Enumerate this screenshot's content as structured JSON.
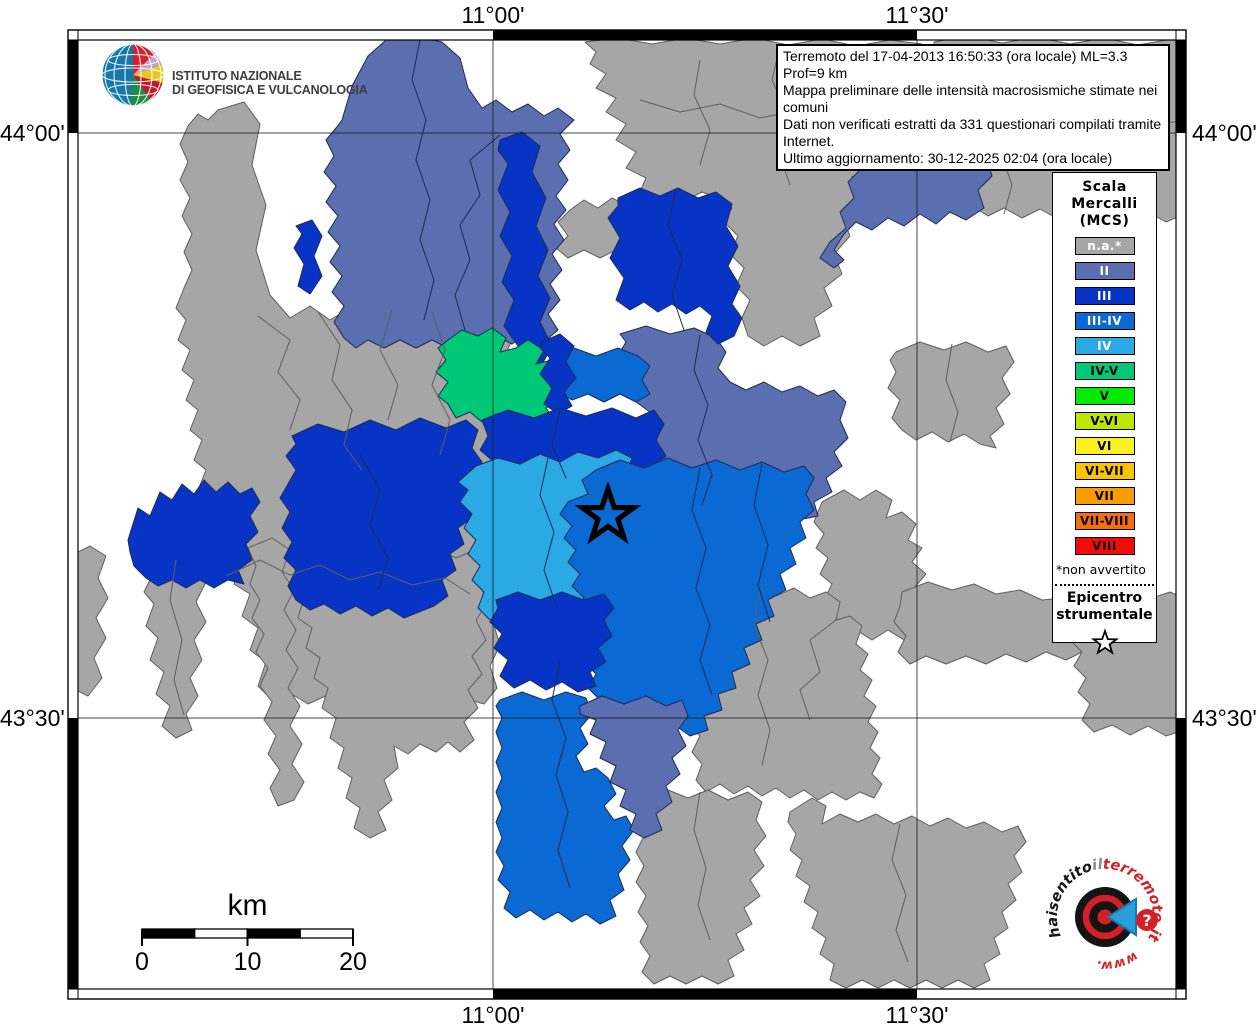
{
  "axes": {
    "meridians": [
      {
        "x": 493,
        "label": "11°00'"
      },
      {
        "x": 917,
        "label": "11°30'"
      }
    ],
    "parallels": [
      {
        "y": 133,
        "label": "44°00'"
      },
      {
        "y": 718,
        "label": "43°30'"
      }
    ]
  },
  "frame": {
    "x": 68,
    "y": 30,
    "w": 1118,
    "h": 969,
    "band": 10
  },
  "infobox": {
    "lines": [
      "Terremoto del 17-04-2013 16:50:33 (ora locale) ML=3.3 Prof=9 km",
      "Mappa preliminare delle intensità macrosismiche stimate nei comuni",
      "Dati non verificati estratti da 331 questionari compilati tramite Internet.",
      "Ultimo aggiornamento: 30-12-2025 02:04 (ora locale)"
    ]
  },
  "legend": {
    "title": "Scala\nMercalli\n(MCS)",
    "items": [
      {
        "key": "na",
        "label": "n.a.*",
        "color": "#A6A6A6",
        "text": "#ffffff"
      },
      {
        "key": "II",
        "label": "II",
        "color": "#5A6EB0",
        "text": "#ffffff"
      },
      {
        "key": "III",
        "label": "III",
        "color": "#0834C6",
        "text": "#ffffff"
      },
      {
        "key": "III-IV",
        "label": "III-IV",
        "color": "#0B69D4",
        "text": "#ffffff"
      },
      {
        "key": "IV",
        "label": "IV",
        "color": "#2BA9E4",
        "text": "#ffffff"
      },
      {
        "key": "IV-V",
        "label": "IV-V",
        "color": "#00C877",
        "text": "#000000"
      },
      {
        "key": "V",
        "label": "V",
        "color": "#00EB00",
        "text": "#000000"
      },
      {
        "key": "V-VI",
        "label": "V-VI",
        "color": "#BEE600",
        "text": "#000000"
      },
      {
        "key": "VI",
        "label": "VI",
        "color": "#FAF01E",
        "text": "#000000"
      },
      {
        "key": "VI-VII",
        "label": "VI-VII",
        "color": "#FAC300",
        "text": "#000000"
      },
      {
        "key": "VII",
        "label": "VII",
        "color": "#FA9B00",
        "text": "#000000"
      },
      {
        "key": "VII-VIII",
        "label": "VII-VIII",
        "color": "#F56E0A",
        "text": "#000000"
      },
      {
        "key": "VIII",
        "label": "VIII",
        "color": "#F50A0A",
        "text": "#000000"
      }
    ],
    "footnote": "*non avvertito",
    "epicenter_label": "Epicentro\nstrumentale"
  },
  "branding": {
    "ingv_name": "ISTITUTO NAZIONALE\nDI GEOFISICA E VULCANOLOGIA",
    "site_parts": {
      "p1": "haisentito",
      "p2": "il",
      "p3": "terremoto.it",
      "p4": "www.",
      "q": "?"
    }
  },
  "scalebar": {
    "title": "km",
    "x": 142,
    "y": 929,
    "w": 211,
    "h": 9,
    "segments": [
      "#000000",
      "#ffffff",
      "#000000",
      "#ffffff"
    ],
    "ticks": [
      {
        "x": 142,
        "label": "0"
      },
      {
        "x": 247.5,
        "label": "10"
      },
      {
        "x": 353,
        "label": "20"
      }
    ]
  },
  "map": {
    "stroke": {
      "na": "#5E5E5E",
      "default": "#1C2B55"
    },
    "grid_color": "#1a1a1a",
    "epicenter": {
      "x": 608,
      "y": 516,
      "r_outer": 27,
      "r_inner": 10.5,
      "stroke_width": 5.2
    },
    "regions": [
      {
        "c": "na",
        "pts": "218,110 244,102 260,124 252,165 266,205 256,250 270,295 290,318 310,306 330,320 350,308 372,322 392,310 412,324 432,312 452,326 472,314 492,328 508,320 515,334 505,355 513,378 503,400 511,422 501,445 509,468 499,490 507,512 497,535 505,558 495,580 503,600 493,622 500,645 490,666 497,688 484,704 462,698 440,708 418,698 396,708 374,696 352,706 330,694 308,704 288,692 272,700 258,686 266,662 250,650 258,628 242,616 250,594 234,584 242,562 228,552 218,562 206,550 214,530 202,520 210,500 198,490 206,470 194,460 202,440 190,430 198,410 186,400 194,380 182,370 190,350 178,340 186,320 176,308 184,288 192,270 184,252 192,234 182,216 190,198 180,180 188,162 180,144 188,126 198,114 208,120"
      },
      {
        "c": "na",
        "pts": "70,556 90,546 106,556 98,578 108,598 96,618 106,638 94,658 102,678 88,696 72,688 70,660"
      },
      {
        "c": "na",
        "pts": "152,568 176,556 196,566 206,582 196,602 206,622 194,640 202,660 190,678 198,696 186,714 192,730 176,738 162,726 170,706 156,694 164,672 150,660 158,638 146,626 154,604 144,592 152,576"
      },
      {
        "c": "na",
        "pts": "248,548 272,538 290,550 282,572 294,590 284,610 296,630 286,650 298,668 288,688 300,706 290,726 302,744 292,764 304,782 294,800 278,806 270,788 280,770 268,754 276,736 264,720 272,702 260,686 268,668 256,652 264,634 252,618 260,600 250,584 256,566"
      },
      {
        "c": "na",
        "pts": "310,552 336,542 360,554 384,544 408,556 432,546 456,558 474,550 486,562 478,582 488,602 476,620 486,640 472,656 482,674 468,690 478,708 464,722 474,740 460,752 448,742 436,752 420,744 408,754 394,746 398,768 384,780 392,800 378,812 386,830 370,838 354,828 360,808 346,798 352,778 338,768 344,748 330,738 336,718 322,708 328,688 314,678 320,658 306,648 312,628 298,618 304,598 290,588 296,568"
      },
      {
        "c": "na",
        "pts": "585,42 618,38 652,44 686,38 720,44 754,38 788,45 822,39 856,46 890,40 922,44 928,62 918,82 926,102 912,122 920,142 906,160 912,178 898,184 882,176 866,186 852,176 856,198 842,214 850,236 834,254 842,274 824,288 832,306 814,318 820,336 800,346 782,336 764,346 748,336 742,318 750,300 736,286 744,268 730,254 738,236 724,222 732,208 718,198 702,192 686,200 670,192 654,200 640,192 646,178 626,168 636,152 616,140 626,124 606,112 616,98 596,88 606,74 590,64 596,52"
      },
      {
        "c": "na",
        "pts": "640,196 628,206 612,198 598,208 584,200 570,210 558,222 568,236 556,248 568,258 584,250 600,258 616,250 632,258 644,246 636,228 648,216 638,204"
      },
      {
        "c": "na",
        "pts": "934,42 968,36 1002,43 1036,37 1070,44 1104,38 1138,45 1172,39 1184,44 1184,214 1166,222 1148,212 1130,221 1112,211 1094,220 1076,210 1058,219 1040,209 1022,218 1004,208 988,216 972,206 978,186 962,174 968,154 952,142 958,122 944,110 950,90 938,76 944,58 934,50"
      },
      {
        "c": "na",
        "pts": "896,352 920,342 944,350 966,342 988,352 1006,346 1014,362 1002,378 1010,394 996,408 1004,424 990,436 996,448 980,444 964,434 948,442 932,432 916,440 902,430 892,418 900,400 888,388 896,372 890,360"
      },
      {
        "c": "na",
        "pts": "822,502 844,490 860,500 876,490 892,500 886,518 902,512 916,524 908,540 922,548 912,562 926,574 914,588 924,602 910,614 920,630 904,640 888,630 872,640 856,630 842,638 830,626 838,610 824,600 832,584 820,574 828,558 816,548 824,534 814,522"
      },
      {
        "c": "na",
        "pts": "902,592 928,582 952,590 974,584 996,594 1020,590 1042,600 1064,598 1086,608 1108,606 1130,618 1148,630 1156,644 1146,658 1126,650 1106,658 1086,650 1066,660 1046,652 1026,662 1006,654 986,664 966,656 946,664 926,656 910,664 898,652 906,636 894,622 900,606"
      },
      {
        "c": "na",
        "pts": "1098,602 1122,592 1146,600 1170,592 1184,598 1184,730 1166,736 1148,726 1130,735 1112,725 1094,732 1082,720 1090,704 1078,692 1086,678 1074,666 1082,652 1070,640 1078,626 1068,614 1076,604"
      },
      {
        "c": "na",
        "pts": "692,628 710,616 704,598 720,588 740,596 758,586 776,596 794,588 810,598 826,592 840,602 836,620 850,616 862,626 856,644 868,654 860,670 872,680 864,696 876,706 868,722 878,732 870,748 880,758 872,774 882,784 874,798 860,792 846,800 832,792 818,800 804,790 790,798 776,788 762,796 748,786 734,794 720,784 706,792 696,780 702,764 692,752 700,736 688,724 696,708 686,694 694,678 684,664 692,650 684,636"
      },
      {
        "c": "na",
        "pts": "648,800 668,790 688,798 708,790 728,800 748,792 762,802 756,820 766,836 754,850 764,866 750,880 760,896 744,908 752,924 736,934 744,950 728,960 734,976 718,984 702,976 686,984 670,976 654,984 642,972 650,956 640,942 648,926 638,912 646,896 636,882 644,866 636,852 644,836 638,822 646,808"
      },
      {
        "c": "na",
        "pts": "790,812 812,798 826,806 822,824 840,814 858,822 876,814 894,824 912,816 930,826 948,818 966,828 984,822 1002,832 1018,826 1026,842 1014,856 1022,872 1008,884 1016,900 1002,912 1008,928 994,938 1000,954 984,964 990,980 974,988 958,980 942,988 926,980 910,988 894,980 878,988 862,980 846,988 830,980 834,964 820,954 826,938 812,928 818,912 804,902 810,886 796,876 802,860 790,850 796,834 788,822"
      },
      {
        "c": "II",
        "pts": "342,120 352,86 368,56 386,40 414,36 442,42 460,58 468,88 482,108 496,100 512,112 528,104 544,116 558,108 574,120 560,134 570,150 558,164 568,180 556,196 566,210 554,224 564,240 552,254 562,270 550,284 560,300 548,314 558,330 544,342 528,334 512,344 496,336 480,346 464,338 448,348 432,340 416,348 400,340 384,348 368,340 356,348 344,338 334,322 344,306 332,292 342,276 330,262 340,246 328,232 338,216 326,202 336,186 324,172 334,156 326,140 336,128"
      },
      {
        "c": "II",
        "pts": "938,110 966,104 988,116 996,138 986,156 992,176 978,190 984,208 966,220 950,212 936,224 920,214 904,226 888,218 872,230 856,222 844,234 834,250 844,260 834,268 820,258 830,242 846,228 840,212 854,198 848,182 862,168 856,152 870,140 864,126 880,132 894,122 910,130 924,118"
      },
      {
        "c": "II",
        "pts": "620,334 646,326 670,334 694,328 716,338 726,352 718,368 730,382 746,390 764,382 782,392 800,386 818,396 834,390 846,402 840,420 848,438 834,452 842,466 826,478 832,492 814,502 818,516 798,520 784,510 768,518 752,508 738,516 724,506 710,514 696,504 682,512 668,502 674,486 660,476 666,460 652,450 658,436 644,426 650,412 636,402 642,388 628,378 634,362 620,352 626,342"
      },
      {
        "c": "III",
        "pts": "500,140 522,132 540,146 532,172 546,198 536,226 548,250 538,276 550,298 540,322 552,346 540,368 526,380 510,370 518,346 504,326 514,300 502,282 512,256 500,236 510,212 498,190 508,164 498,150"
      },
      {
        "c": "III",
        "pts": "618,198 640,188 660,196 678,188 698,198 716,192 732,204 726,226 738,246 728,266 740,286 732,304 742,318 734,336 718,344 706,332 712,316 700,306 686,314 672,304 658,312 644,302 630,310 616,300 624,278 610,258 620,238 608,218 618,206"
      },
      {
        "c": "III-IV",
        "pts": "552,356 574,348 596,356 618,348 638,356 650,366 642,380 650,394 636,402 620,394 604,402 588,394 572,400 558,392 566,378 554,368"
      },
      {
        "c": "IV-V",
        "pts": "448,340 462,330 478,336 492,328 506,338 500,352 516,348 528,340 544,350 536,364 552,360 562,372 550,386 560,398 546,408 554,420 538,426 524,416 510,424 496,414 482,422 470,412 456,418 448,404 438,396 448,382 436,372 446,360 438,348"
      },
      {
        "c": "III",
        "pts": "542,342 560,334 574,346 566,362 576,378 564,392 572,406 558,414 544,404 552,388 540,374 550,358 540,348"
      },
      {
        "c": "III",
        "pts": "482,420 508,410 534,418 560,408 586,416 612,408 636,418 654,410 664,424 656,440 666,456 652,468 658,482 642,492 628,484 612,494 596,486 580,494 564,486 548,494 532,486 516,494 500,486 488,478 494,462 480,450 488,436"
      },
      {
        "c": "III",
        "pts": "292,436 318,424 344,432 370,420 396,430 420,418 446,428 466,420 478,430 472,448 482,462 470,476 478,490 466,502 472,518 458,528 464,544 450,554 456,570 442,580 448,596 434,606 404,618 388,608 372,616 356,606 340,614 324,604 310,610 296,600 288,586 296,570 284,558 292,542 282,528 290,512 280,498 288,484 296,470 286,456 296,444"
      },
      {
        "c": "III",
        "pts": "296,226 312,220 322,236 314,256 322,276 310,294 298,286 304,264 294,248 302,234"
      },
      {
        "c": "III",
        "pts": "128,540 138,508 150,516 160,492 172,500 182,484 194,494 204,480 216,492 228,482 240,494 252,488 260,502 250,516 258,532 246,544 252,560 238,570 244,584 228,580 214,588 200,580 186,588 172,580 158,586 146,578 134,566 130,552"
      },
      {
        "c": "IV",
        "pts": "458,482 476,466 498,458 520,464 540,454 560,462 578,452 598,458 616,450 632,458 626,474 636,486 626,500 638,512 628,526 640,538 630,552 642,564 630,578 640,590 626,602 632,614 616,622 600,614 584,622 568,614 552,622 536,614 520,622 504,614 490,620 478,608 484,592 472,580 480,566 468,554 476,540 464,528 472,514 460,502 468,490"
      },
      {
        "c": "III-IV",
        "pts": "596,470 620,460 644,468 668,458 692,468 716,460 740,470 762,462 784,472 804,466 814,478 806,494 814,510 800,522 806,538 790,548 796,564 780,574 786,590 768,600 774,616 756,624 762,640 744,648 750,664 732,672 736,688 718,694 722,710 704,716 708,730 690,736 676,726 660,734 646,724 632,732 618,722 604,728 592,716 600,700 588,688 596,674 584,662 592,648 580,636 588,622 576,610 584,598 572,586 580,574 568,562 576,550 564,538 572,526 560,514 568,502 588,494 582,480"
      },
      {
        "c": "III",
        "pts": "496,600 518,592 540,600 562,592 584,600 604,594 614,608 604,620 612,636 598,648 606,662 590,672 596,686 578,692 562,682 546,690 530,680 514,688 500,676 508,660 494,648 502,634 490,622 498,608"
      },
      {
        "c": "III-IV",
        "pts": "500,700 522,692 544,700 566,692 586,698 592,714 580,728 588,744 576,756 584,772 596,768 608,778 616,794 604,806 614,820 626,816 634,830 622,846 630,860 618,874 624,890 610,900 616,916 600,924 586,914 572,922 558,912 544,920 530,910 516,918 504,908 510,892 498,880 504,866 496,852 502,838 496,822 502,808 496,792 502,778 496,762 502,748 496,732 502,718 496,706"
      },
      {
        "c": "II",
        "pts": "580,706 602,696 624,704 646,696 666,706 682,700 688,716 678,730 686,746 672,758 680,774 666,786 672,802 656,814 662,830 644,838 630,830 636,814 620,806 626,790 610,782 616,766 600,758 606,742 590,734 596,720 580,714"
      }
    ],
    "borders": [
      {
        "c": "na",
        "pts": "258,316 290,340 278,372 300,400 290,430"
      },
      {
        "c": "na",
        "pts": "318,312 340,345 332,380 352,410 344,445 362,470"
      },
      {
        "c": "na",
        "pts": "392,310 380,350 398,385 388,420"
      },
      {
        "c": "na",
        "pts": "432,312 445,350 432,385 450,420 440,455"
      },
      {
        "c": "na",
        "pts": "226,576 260,560 290,575 320,565 350,580 380,572 412,585 445,578 470,594"
      },
      {
        "c": "na",
        "pts": "700,60 694,95 710,130 700,165"
      },
      {
        "c": "na",
        "pts": "780,45 772,80 788,115 778,150 790,185"
      },
      {
        "c": "na",
        "pts": "860,46 852,85 866,120 856,160"
      },
      {
        "c": "na",
        "pts": "640,100 680,112 720,104 760,118 800,110 845,122 890,112"
      },
      {
        "c": "na",
        "pts": "1000,44 994,80 1010,115 1000,150 1012,185 1004,214"
      },
      {
        "c": "na",
        "pts": "1080,44 1072,85 1088,125 1078,165 1090,200"
      },
      {
        "c": "na",
        "pts": "944,110 985,120 1020,112 1060,124 1100,116 1140,128 1184,120"
      },
      {
        "c": "na",
        "pts": "952,344 946,380 958,412 950,442"
      },
      {
        "c": "na",
        "pts": "900,824 892,860 906,895 896,930 908,962"
      },
      {
        "c": "na",
        "pts": "700,792 694,830 706,868 698,905 710,940"
      },
      {
        "c": "na",
        "pts": "176,560 170,600 182,640 174,680 184,715"
      },
      {
        "c": "na",
        "pts": "760,588 754,625 768,660 758,695 770,730 762,765"
      },
      {
        "c": "na",
        "pts": "836,620 810,640 820,672 800,690 810,720"
      },
      {
        "c": "default",
        "pts": "420,40 412,80 426,120 416,160 430,200 420,240 434,280 424,320"
      },
      {
        "c": "default",
        "pts": "500,135 470,160 480,195 460,225 470,260 455,295 465,330"
      },
      {
        "c": "default",
        "pts": "700,335 694,370 708,405 698,440 712,475 702,505"
      },
      {
        "c": "default",
        "pts": "676,190 668,225 682,260 672,295 684,330"
      },
      {
        "c": "default",
        "pts": "360,455 380,490 370,525 388,558 378,590"
      },
      {
        "c": "default",
        "pts": "560,410 552,445 566,478"
      },
      {
        "c": "default",
        "pts": "700,468 692,510 706,548 696,588 710,625 700,660 712,695"
      },
      {
        "c": "default",
        "pts": "762,464 754,505 768,545 758,585 770,622"
      },
      {
        "c": "default",
        "pts": "548,458 540,495 554,532 544,570 556,605"
      },
      {
        "c": "default",
        "pts": "560,662 552,700 566,738 556,775 568,812 558,850 570,888"
      }
    ]
  }
}
